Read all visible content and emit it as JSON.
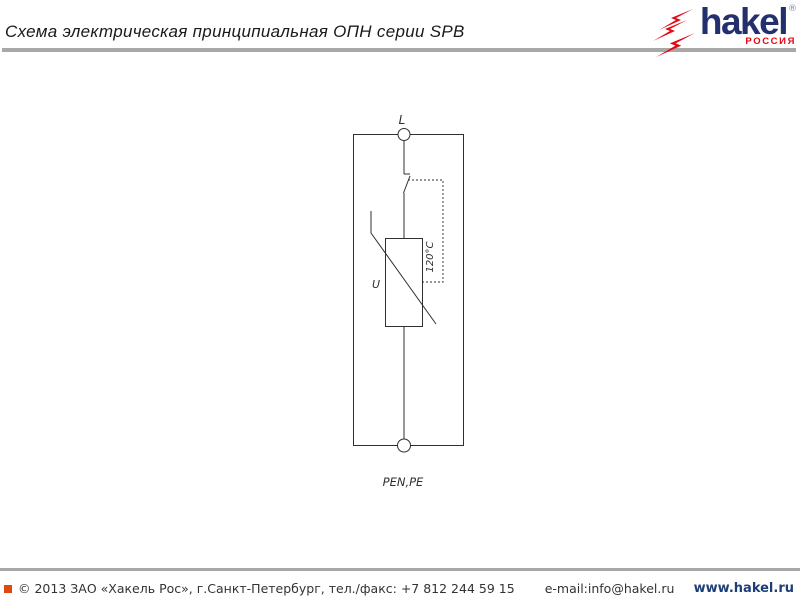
{
  "page": {
    "title": "Схема электрическая принципиальная ОПН серии SPB"
  },
  "logo": {
    "brand": "hakel",
    "registered": "®",
    "country": "РОССИЯ",
    "brand_color": "#22306e",
    "accent_red": "#e30613"
  },
  "schematic": {
    "terminal_top_label": "L",
    "varistor_label": "U",
    "thermal_disconnect_label": "120°C",
    "terminal_bottom_label": "PEN,PE",
    "line_color": "#2f2f2f"
  },
  "footer": {
    "copyright": "© 2013 ЗАО «Хакель Рос», г.Санкт-Петербург, тел./факс: +7 812 244 59 15",
    "email": "e-mail:info@hakel.ru",
    "website": "www.hakel.ru",
    "bullet_color": "#e04a12"
  }
}
